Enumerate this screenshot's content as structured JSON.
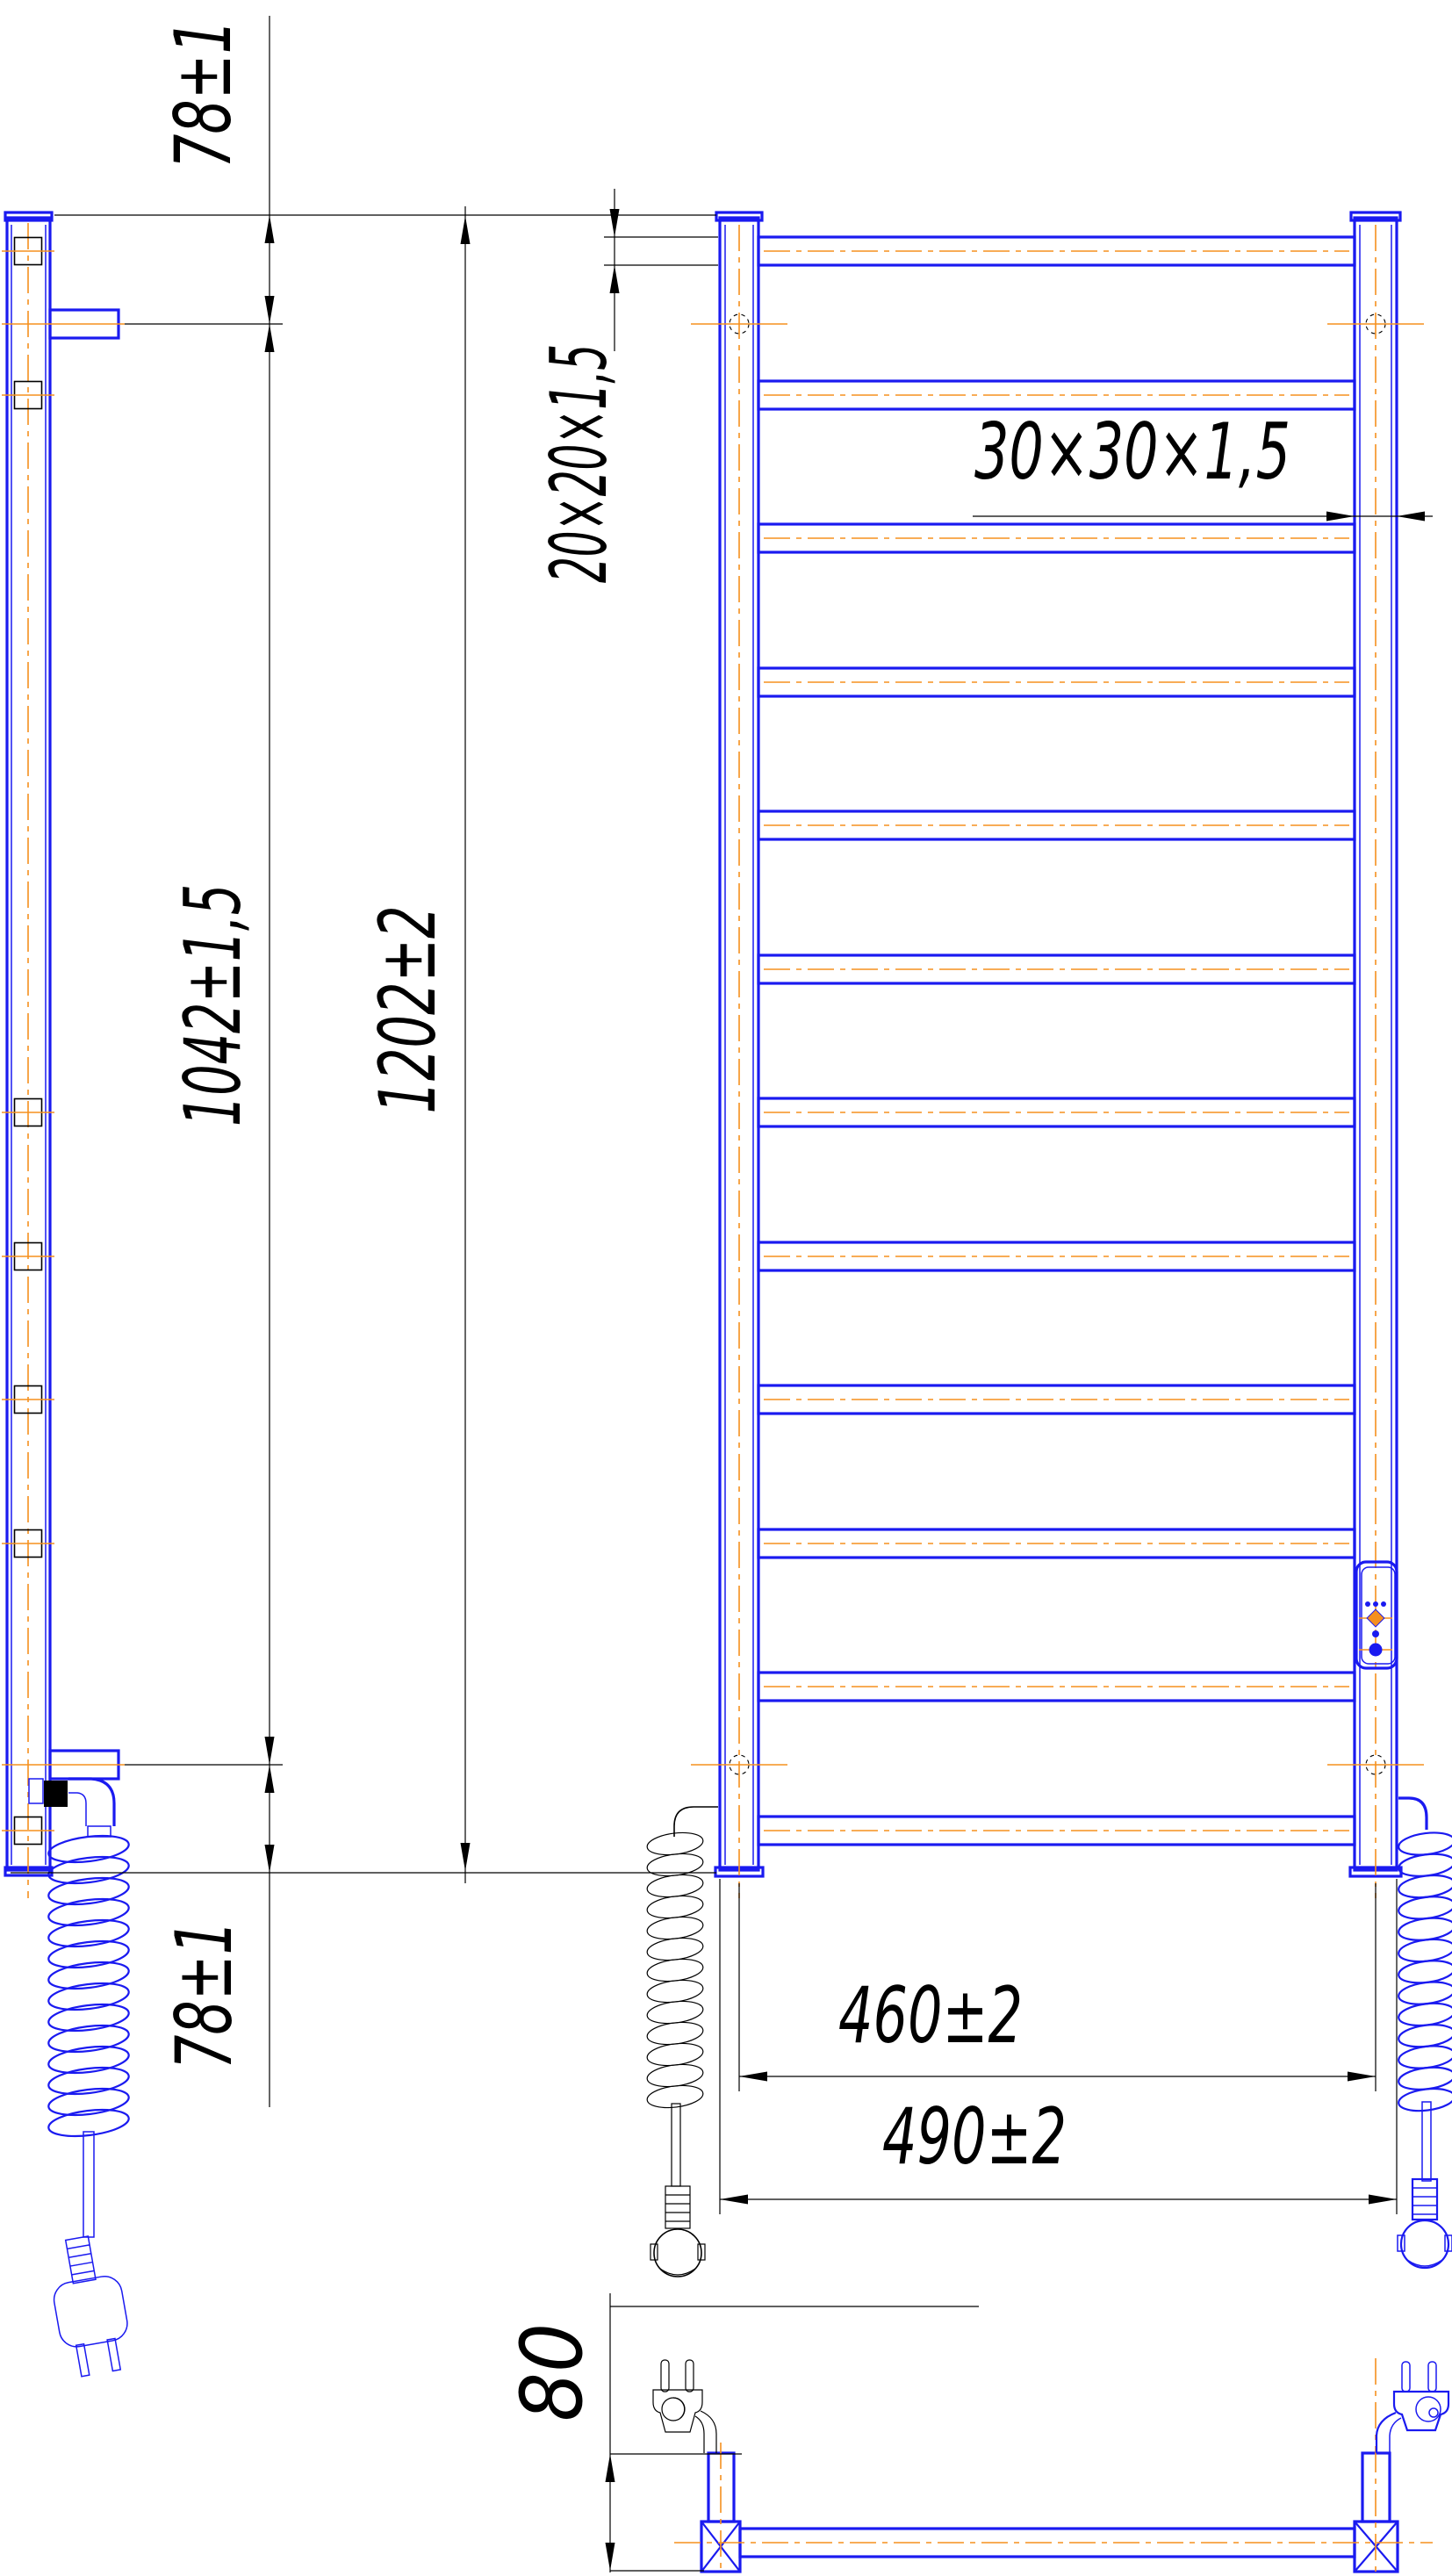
{
  "document": {
    "type": "technical-drawing",
    "subject": "Electric heated towel rail — dimensional drawing, three projections",
    "units": "mm"
  },
  "colors": {
    "product_outline": "#1a1af0",
    "centerline": "#f5901e",
    "dimension": "#000000",
    "background": "#ffffff"
  },
  "views": {
    "side": {
      "name": "side-view",
      "rung_sections": 7,
      "wall_brackets": 2,
      "has_coiled_cable": true,
      "has_plug": true
    },
    "front": {
      "name": "front-view",
      "rung_count": 12,
      "post_count": 2,
      "mount_holes": 4,
      "has_control_panel": true,
      "control_panel_leds": 3,
      "coiled_cables": 2
    },
    "bottom": {
      "name": "bottom-view",
      "plug_count": 2,
      "bracket_cross_marks": 2
    }
  },
  "dimensions": {
    "top_offset": "78±1",
    "mount_span": "1042±1,5",
    "overall_height": "1202±2",
    "rung_tube_section": "20×20×1,5",
    "post_tube_section": "30×30×1,5",
    "bottom_offset": "78±1",
    "mount_width": "460±2",
    "overall_width": "490±2",
    "depth": "80"
  }
}
